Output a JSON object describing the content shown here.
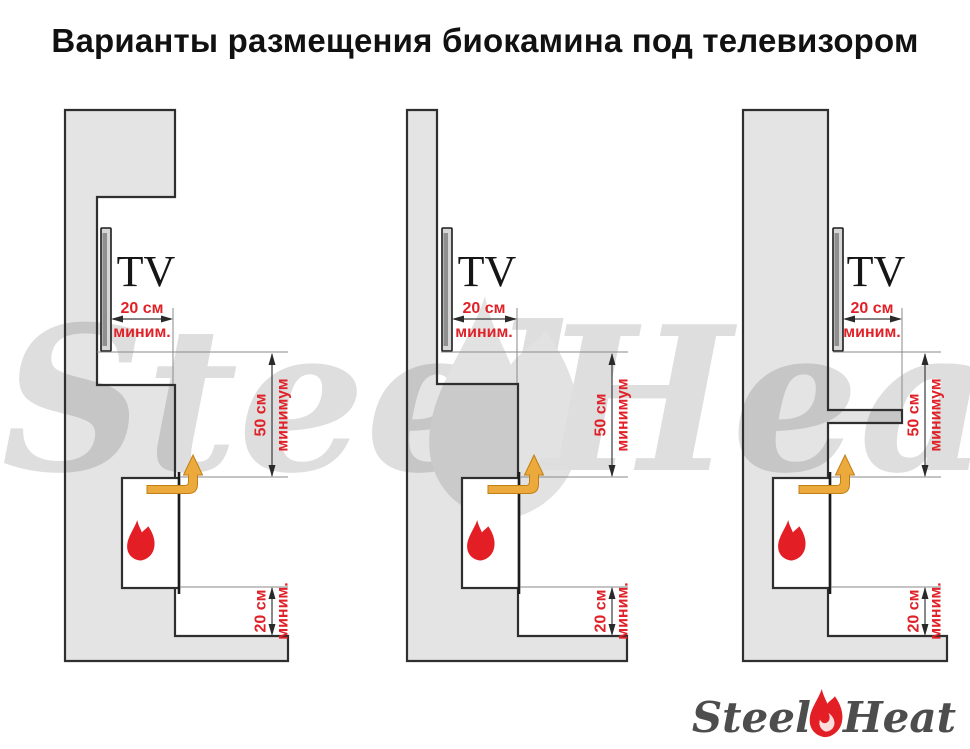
{
  "title": "Варианты размещения биокамина под телевизором",
  "labels": {
    "tv": "TV"
  },
  "watermark": {
    "steel": "Steel",
    "heat": "Heat"
  },
  "logo": {
    "steel": "Steel",
    "heat": "Heat"
  },
  "diagrams": [
    {
      "name": "tv-in-niche",
      "tv_label": "TV",
      "dim_front": {
        "value": "20 см",
        "qualifier": "миним."
      },
      "dim_middle": {
        "value": "50 см",
        "qualifier": "минимум"
      },
      "dim_bottom": {
        "value": "20 см",
        "qualifier": "миним."
      }
    },
    {
      "name": "tv-on-wall-step",
      "tv_label": "TV",
      "dim_front": {
        "value": "20 см",
        "qualifier": "миним."
      },
      "dim_middle": {
        "value": "50 см",
        "qualifier": "минимум"
      },
      "dim_bottom": {
        "value": "20 см",
        "qualifier": "миним."
      }
    },
    {
      "name": "tv-on-wall-with-shelf",
      "tv_label": "TV",
      "dim_front": {
        "value": "20 см",
        "qualifier": "миним."
      },
      "dim_middle": {
        "value": "50 см",
        "qualifier": "минимум"
      },
      "dim_bottom": {
        "value": "20 см",
        "qualifier": "миним."
      }
    }
  ],
  "colors": {
    "wall_fill": "#e4e4e4",
    "outline": "#2f2f2f",
    "accent_red": "#e31e24",
    "arrow_orange": "#ecaa3d",
    "logo_text": "#4d4d4d",
    "watermark": "#dedede"
  }
}
